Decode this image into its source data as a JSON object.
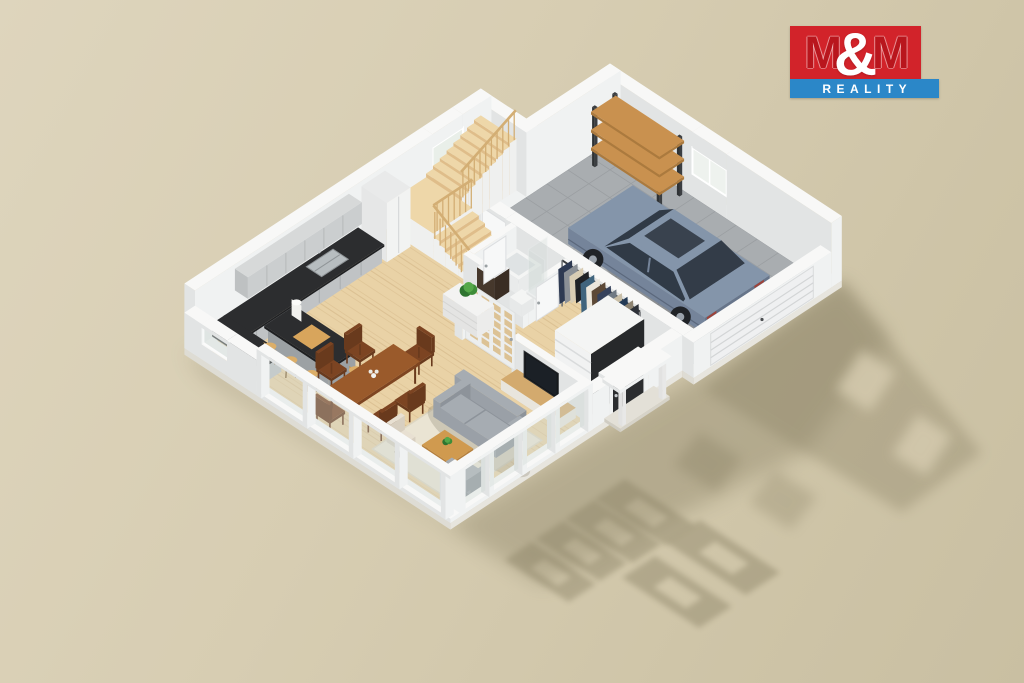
{
  "meta": {
    "description": "3D rendered isometric floor plan of a family house ground floor with attached garage"
  },
  "logo": {
    "m_left": "M",
    "amp": "&",
    "m_right": "M",
    "subtitle": "REALITY"
  },
  "colors": {
    "logo_red": "#d2232a",
    "logo_red_dark": "#b9161d",
    "logo_blue": "#2b87c8",
    "bg_mid": "#d5cbaf",
    "shadow": "#8d8468",
    "wall_top": "#f8f8f7",
    "wall_bright": "#f0f2f2",
    "wall_shade": "#e2e4e4",
    "wall_dim": "#d8dada",
    "slab_edge_u": "#e7e5de",
    "slab_edge_v": "#dedcd4",
    "slab_top": "#f2f1ed",
    "wood_floor": "#e9d2a6",
    "wood_streak": "#c8a878",
    "tile": "#a9adb0",
    "tile_line": "#999da0",
    "bath_tile": "#c6cacc",
    "bath_line": "#b4b8ba",
    "stair_top": "#eed7a9",
    "stair_riser": "#dfbd8a",
    "stair_side": "#eff0ef",
    "rail_wood": "#d3ae74",
    "counter_dark": "#2c2d2f",
    "cabinet": "#c0c3c5",
    "cabinet_line": "#a9adaf",
    "upper_cab": "#cbcecf",
    "island": "#9ca1a4",
    "board": "#d8a55c",
    "stool": "#dcae68",
    "stool_side": "#c3944f",
    "table_wood": "#9a5a2b",
    "table_side": "#7e4521",
    "chair_wood": "#7c4422",
    "chair_dark": "#693a1d",
    "sofa": "#a6acb2",
    "sofa_shade": "#8d939a",
    "sofa_dark": "#9aa0a7",
    "rug": "#eae4d3",
    "rug_edge": "#ddd6c2",
    "coffee": "#d09a4f",
    "coffee_side": "#b57f3c",
    "cream_chair": "#e8e0d2",
    "cream_chair_shade": "#d8cfc0",
    "tv": "#121416",
    "bench": "#d3aa6e",
    "bench_side": "#e8e5dd",
    "door_dark": "#2b2d2f",
    "door_white": "#f7f8f8",
    "glass": "#cfd9d6",
    "window_glow": "#eef2ee",
    "plant": "#3e8d39",
    "plant_dark": "#2e7430",
    "plant_light": "#55a84a",
    "car_body": "#75849a",
    "car_top": "#8495aa",
    "car_shade": "#67758a",
    "car_glass": "#303a46",
    "wheel": "#202327",
    "hub": "#9aa2ab",
    "taillight": "#a04238",
    "rack_frame": "#3b3e41",
    "rack_shelf": "#c9914f",
    "rack_shelf_side": "#ab7a3e",
    "wardrobe_line": "#d9dbdc",
    "lattice_wood": "#d9ba85"
  },
  "clothes_palette": [
    "#2e3a52",
    "#8b9096",
    "#d9cdb4",
    "#1f2125",
    "#40647d",
    "#ece7dc",
    "#5c4937",
    "#36425c",
    "#6f7984",
    "#c8bea7",
    "#233a55",
    "#8d8371",
    "#2d3138",
    "#b9ad93"
  ],
  "scene": {
    "rooms": [
      "garage",
      "entry-hall",
      "bathroom",
      "hallway",
      "stair-hall",
      "kitchen",
      "dining-area",
      "living-room"
    ],
    "layers": [
      "backdrop",
      "cast-shadows",
      "floor-slab",
      "garage-floor",
      "house-floor",
      "bathroom-floor",
      "back-walls",
      "shelf-rack",
      "car",
      "garage-partition-wall",
      "garage-door-wall",
      "staircase",
      "stair-railing",
      "kitchen-tall-cabinet",
      "kitchen-upper-cabinets",
      "kitchen-counter",
      "kitchen-island",
      "bar-stools",
      "bathroom-walls",
      "bathroom-fixtures",
      "interior-doors",
      "clothes-rack",
      "wardrobe",
      "hallway-wall",
      "slatted-partition",
      "plant-dresser",
      "dining-set",
      "living-rug",
      "tv-bench",
      "tv",
      "sofa",
      "coffee-table",
      "armchair",
      "side-chair",
      "se-window-wall",
      "sw-window-wall",
      "entry-canopy"
    ]
  }
}
